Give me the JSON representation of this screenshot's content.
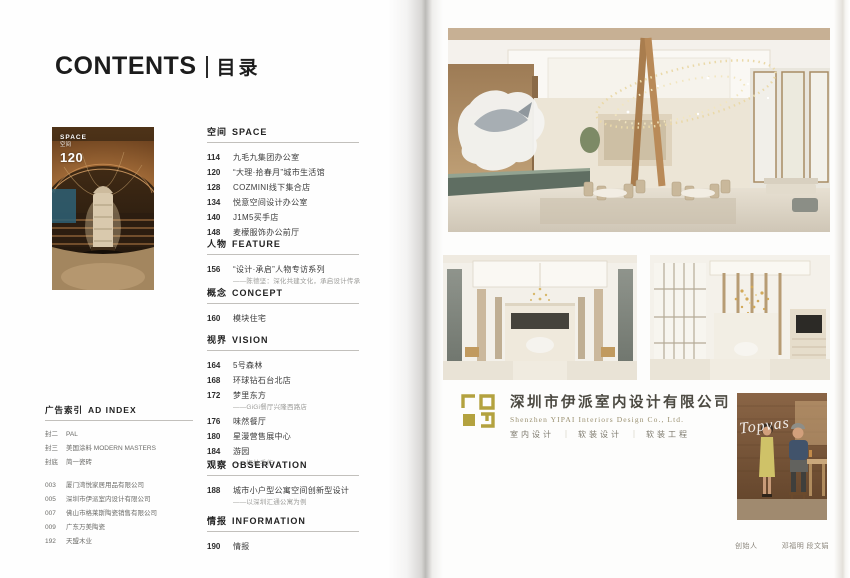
{
  "contents": {
    "title_en": "CONTENTS",
    "title_zh": "目录"
  },
  "thumbnail": {
    "tag_en": "SPACE",
    "tag_zh": "空间",
    "page_no": "120"
  },
  "toc": [
    {
      "zh": "空间",
      "en": "SPACE",
      "items": [
        {
          "no": "114",
          "title": "九毛九集团办公室"
        },
        {
          "no": "120",
          "title": "“大理·拾春月”城市生活馆"
        },
        {
          "no": "128",
          "title": "COZMINI线下集合店"
        },
        {
          "no": "134",
          "title": "悦意空间设计办公室"
        },
        {
          "no": "140",
          "title": "J1M5买手店"
        },
        {
          "no": "148",
          "title": "麦檬服饰办公前厅"
        }
      ]
    },
    {
      "zh": "人物",
      "en": "FEATURE",
      "items": [
        {
          "no": "156",
          "title": "“设计·承启”人物专访系列",
          "sub": "——陈德坚：深化共建文化，承启设计传承"
        }
      ]
    },
    {
      "zh": "概念",
      "en": "CONCEPT",
      "items": [
        {
          "no": "160",
          "title": "模块住宅"
        }
      ]
    },
    {
      "zh": "视界",
      "en": "VISION",
      "items": [
        {
          "no": "164",
          "title": "5号森林"
        },
        {
          "no": "168",
          "title": "环球钻石台北店"
        },
        {
          "no": "172",
          "title": "梦里东方",
          "sub": "——GiGi餐厅兴隆西路店"
        },
        {
          "no": "176",
          "title": "味然餐厅"
        },
        {
          "no": "180",
          "title": "星漫营售展中心"
        },
        {
          "no": "184",
          "title": "游园",
          "sub": "——梅林手作"
        }
      ]
    },
    {
      "zh": "观察",
      "en": "OBSERVATION",
      "items": [
        {
          "no": "188",
          "title": "城市小户型公寓空间创新型设计",
          "sub": "——以深圳汇通公寓为例"
        }
      ]
    },
    {
      "zh": "情报",
      "en": "INFORMATION",
      "items": [
        {
          "no": "190",
          "title": "情报"
        }
      ]
    }
  ],
  "ad_index": {
    "zh": "广告索引",
    "en": "AD INDEX",
    "covers": [
      {
        "no": "封二",
        "title": "PAL"
      },
      {
        "no": "封三",
        "title": "美国涂料 MODERN MASTERS"
      },
      {
        "no": "封底",
        "title": "简一瓷砖"
      }
    ],
    "pages": [
      {
        "no": "003",
        "title": "厦门湾悦家居用品有限公司"
      },
      {
        "no": "005",
        "title": "深圳市伊派室内设计有限公司"
      },
      {
        "no": "007",
        "title": "佛山市格莱斯陶瓷销售有限公司"
      },
      {
        "no": "009",
        "title": "广东万美陶瓷"
      },
      {
        "no": "192",
        "title": "天盟木业"
      }
    ]
  },
  "company": {
    "name_zh": "深圳市伊派室内设计有限公司",
    "name_en": "Shenzhen YIPAI Interiors Design Co., Ltd.",
    "services": [
      "室内设计",
      "软装设计",
      "软装工程"
    ],
    "sep": "｜",
    "logo_color": "#b3a23f"
  },
  "founders": {
    "label": "创始人",
    "names": "邓福明 段文娟",
    "photo_script": "Topvas"
  },
  "colors": {
    "accent_gold": "#b3a23f",
    "text_dark": "#1c1c1c",
    "text_gray": "#9b9b98"
  }
}
